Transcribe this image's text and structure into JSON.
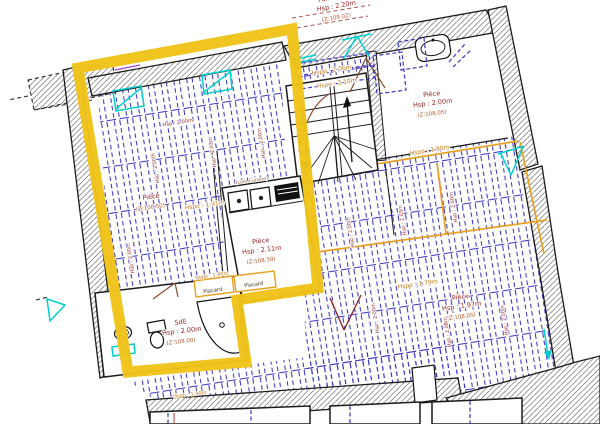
{
  "meta": {
    "type": "architectural-floor-plan",
    "highlight_color": "#efc319"
  },
  "colors": {
    "highlight_yellow": "#efc319",
    "joist_blue": "#3b35c4",
    "window_cyan": "#00cfcf",
    "partition_orange": "#e8a020",
    "room_text_red": "#9b2424",
    "height_text_orange": "#c07818",
    "wall_black": "#1b1b1b",
    "door_brown": "#8a4a2c"
  },
  "labels": {
    "palier": {
      "name": "Palier R+1",
      "hsp": "Hsp : 2.20m",
      "z": "(Z:109.02)"
    },
    "stair_upper": "Hspo : 2.06m",
    "stair_lower": "Hspo : 2.10m",
    "room_top_right": {
      "name": "Pièce",
      "hsp": "Hsp : 2.00m",
      "z": "(Z:108.05)"
    },
    "hspo_180": "Hspo : 1.80m",
    "room_left": {
      "name": "Pièce",
      "z": "(Z:108.50)"
    },
    "hspo_191": "Hspo : 1.91m",
    "coin_cuisine": "(coin Cuisine)",
    "room_kitchen": {
      "name": "Pièce",
      "hsp": "Hsp : 2.11m",
      "z": "(Z:108.50)"
    },
    "placard_left": "Placard",
    "placard_right": "Placard",
    "hspo_190": "Hspo : 1.90m",
    "room_sde": {
      "name": "SdE",
      "hsp": "Hsp : 2.00m",
      "z": "(Z:108.00)"
    },
    "room_bottom_right": {
      "name": "Pièce",
      "hsp": "Hsp : 1.97m",
      "z": "(Z:108.05)"
    },
    "hspo_179": "Hspo : 1.79m",
    "hspo_bottom": "Hspo : 1.90m",
    "rot": [
      "Hsp : 2.00m",
      "Hsp : 2.03m",
      "Hsp : 2.00m",
      "Hsp : 2.00m",
      "Hsp : 2.03m",
      "Hsp : 2.00m",
      "Hsp : 2.00m",
      "Hsp : 2.08m",
      "Hsp : 2.00m",
      "Hsp : 2.00m",
      "Hsp : 2.00m"
    ]
  }
}
